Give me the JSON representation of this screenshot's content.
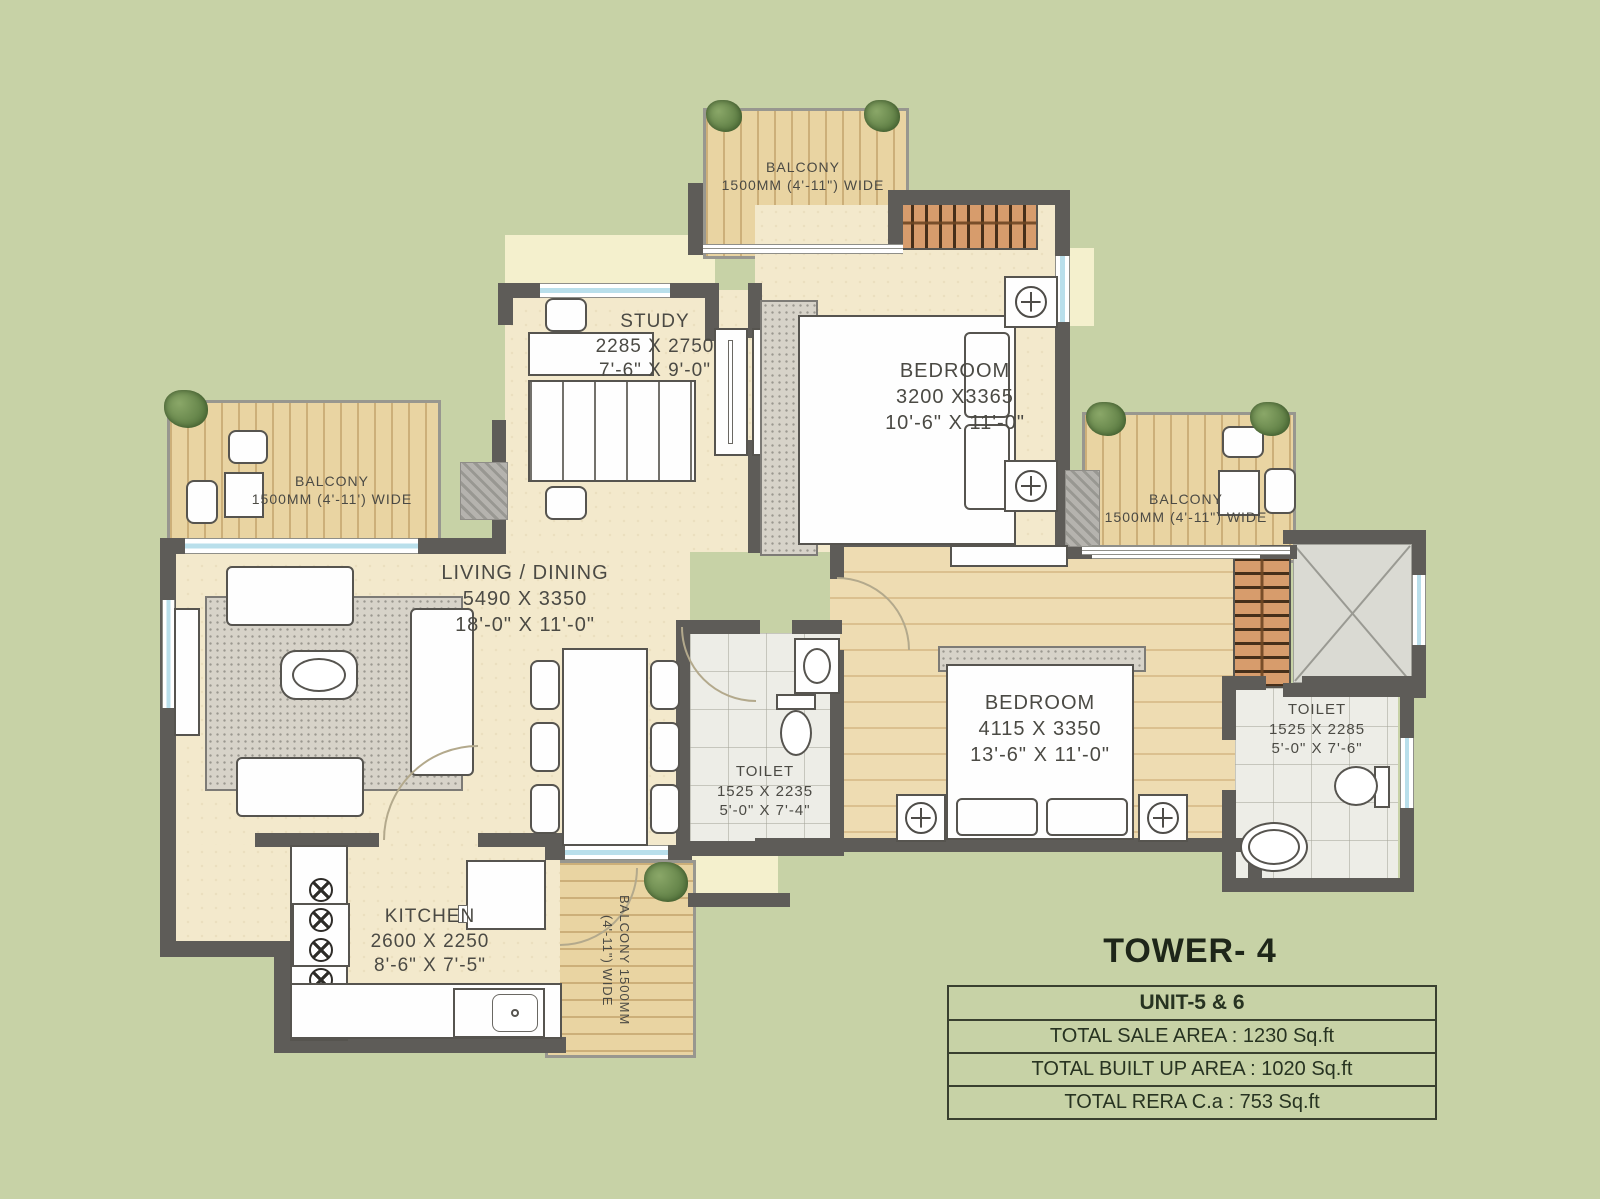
{
  "plan_title": {
    "tower": "TOWER- 4"
  },
  "info_table": {
    "unit_header": "UNIT-5 & 6",
    "rows": [
      "TOTAL SALE AREA : 1230 Sq.ft",
      "TOTAL BUILT UP AREA : 1020 Sq.ft",
      "TOTAL RERA C.a : 753 Sq.ft"
    ]
  },
  "rooms": {
    "study": {
      "name": "STUDY",
      "dim_mm": "2285 X 2750",
      "dim_ft": "7'-6\" X 9'-0\""
    },
    "bedroom1": {
      "name": "BEDROOM",
      "dim_mm": "3200 X3365",
      "dim_ft": "10'-6\" X 11'-0\""
    },
    "living_dining": {
      "name": "LIVING / DINING",
      "dim_mm": "5490 X 3350",
      "dim_ft": "18'-0\" X 11'-0\""
    },
    "toilet_center": {
      "name": "TOILET",
      "dim_mm": "1525 X 2235",
      "dim_ft": "5'-0\" X 7'-4\""
    },
    "bedroom2": {
      "name": "BEDROOM",
      "dim_mm": "4115 X 3350",
      "dim_ft": "13'-6\" X 11'-0\""
    },
    "toilet_right": {
      "name": "TOILET",
      "dim_mm": "1525 X 2285",
      "dim_ft": "5'-0\" X 7'-6\""
    },
    "kitchen": {
      "name": "KITCHEN",
      "dim_mm": "2600 X 2250",
      "dim_ft": "8'-6\" X 7'-5\""
    }
  },
  "balconies": {
    "top": {
      "name": "BALCONY",
      "size": "1500MM (4'-11\") WIDE"
    },
    "left": {
      "name": "BALCONY",
      "size": "1500MM (4'-11') WIDE"
    },
    "right": {
      "name": "BALCONY",
      "size": "1500MM (4'-11\") WIDE"
    },
    "bottom": {
      "name": "BALCONY",
      "size": "1500MM (4'-11\") WIDE"
    }
  },
  "colors": {
    "background": "#c7d2a6",
    "floor_cream": "#f3e9cc",
    "floor_wood": "#eedcb2",
    "balcony_wood": "#e9d4a2",
    "wall": "#5e5c58",
    "wardrobe": "#d79c6c",
    "tile": "#edede7",
    "window_glass": "#b9dfeb",
    "label_text": "#4b4a44",
    "table_text": "#273321"
  }
}
